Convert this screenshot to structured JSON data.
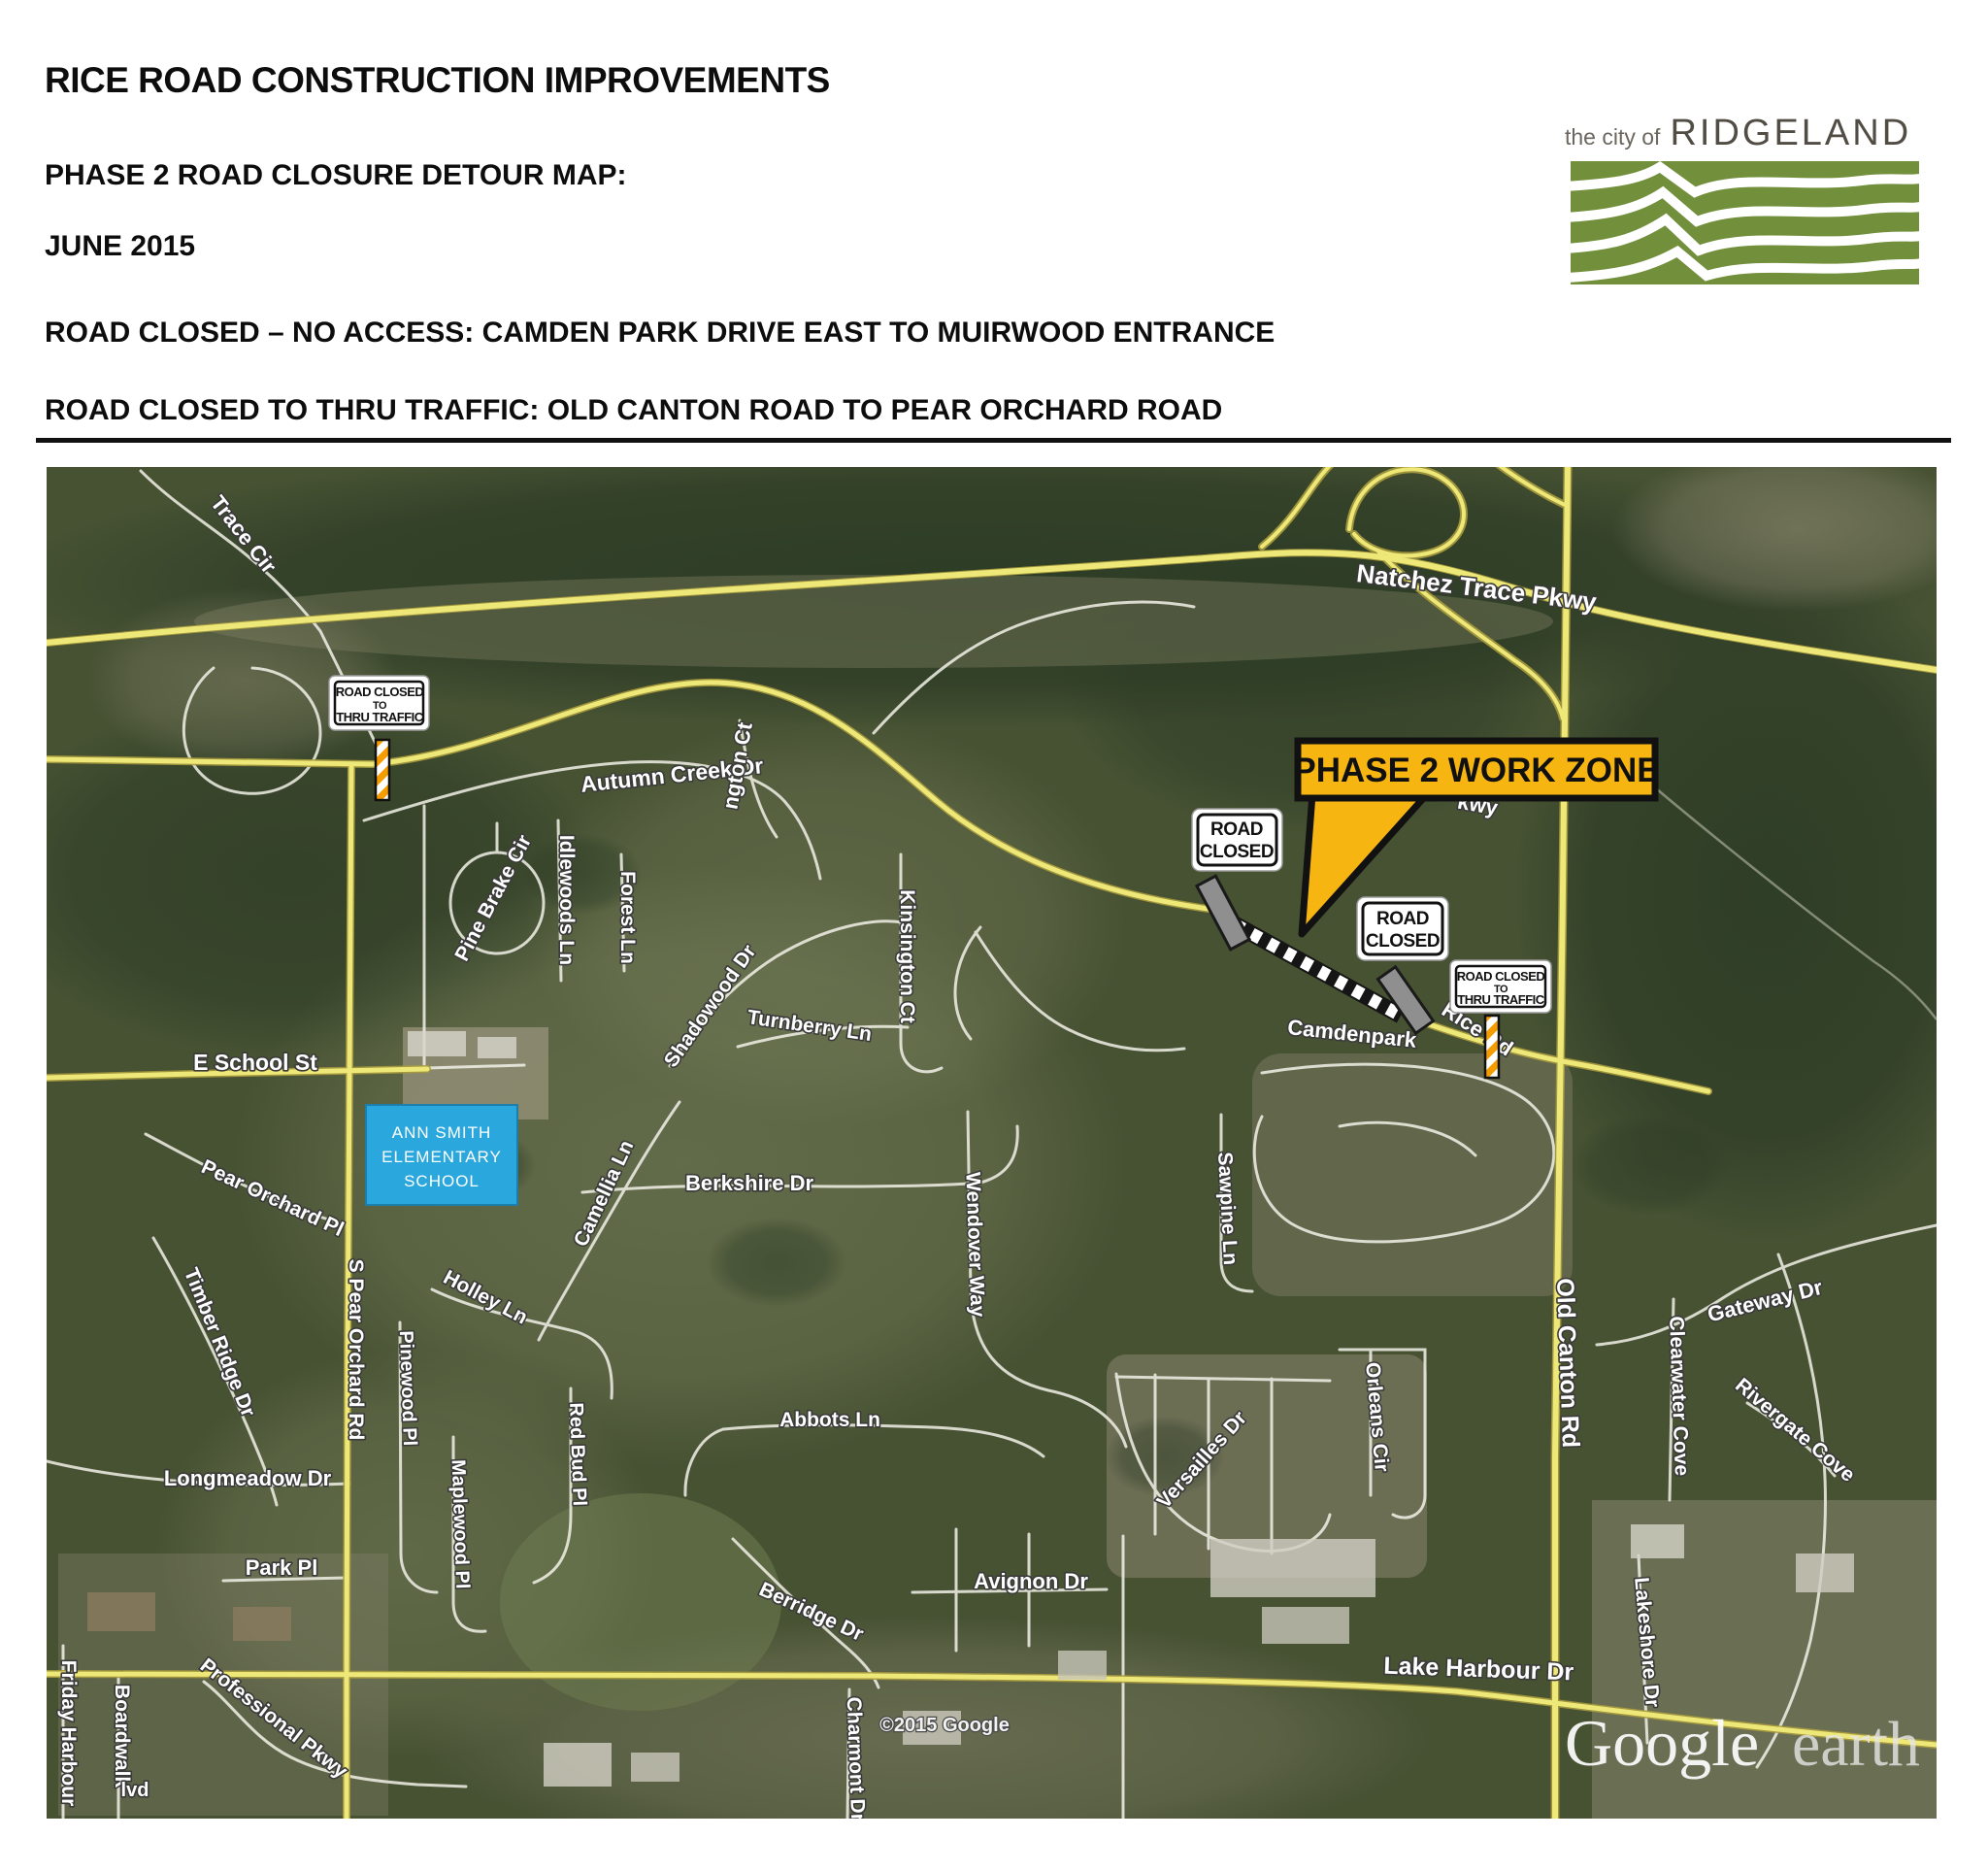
{
  "header": {
    "title": "RICE ROAD CONSTRUCTION IMPROVEMENTS",
    "subtitle": "PHASE 2 ROAD CLOSURE DETOUR MAP:",
    "date": "JUNE 2015",
    "closure_no_access": "ROAD CLOSED – NO ACCESS: CAMDEN PARK DRIVE EAST TO MUIRWOOD ENTRANCE",
    "closure_thru": "ROAD CLOSED TO THRU TRAFFIC:  OLD CANTON ROAD TO PEAR ORCHARD ROAD"
  },
  "logo": {
    "tagline": "the city of",
    "city": "RIDGELAND"
  },
  "colors": {
    "logo_green": "#72903c",
    "callout_bg": "#f7b512",
    "school_bg": "#2aa7dc",
    "school_border": "#1c7fab",
    "road_yellow": "#eee878",
    "sign_bg": "#ffffff"
  },
  "map": {
    "attribution": "©2015 Google",
    "watermark": {
      "brand": "Google",
      "suffix": "earth"
    },
    "callout": {
      "label": "PHASE 2 WORK ZONE"
    },
    "signs": [
      {
        "id": "thru-traffic-west",
        "lines": [
          "ROAD CLOSED",
          "TO",
          "THRU TRAFFIC"
        ]
      },
      {
        "id": "road-closed-west",
        "lines": [
          "ROAD",
          "CLOSED"
        ]
      },
      {
        "id": "road-closed-east",
        "lines": [
          "ROAD",
          "CLOSED"
        ]
      },
      {
        "id": "thru-traffic-east",
        "lines": [
          "ROAD CLOSED",
          "TO",
          "THRU TRAFFIC"
        ]
      }
    ],
    "school": {
      "lines": [
        "ANN SMITH",
        "ELEMENTARY",
        "SCHOOL"
      ]
    },
    "street_labels": [
      {
        "text": "Trace Cir"
      },
      {
        "text": "Natchez Trace Pkwy"
      },
      {
        "text": "Autumn Creek Dr"
      },
      {
        "text": "ngton Ct"
      },
      {
        "text": "Pine Brake Cir"
      },
      {
        "text": "Idlewoods Ln"
      },
      {
        "text": "Forest Ln"
      },
      {
        "text": "Kinsington Ct"
      },
      {
        "text": "Shadowood Dr"
      },
      {
        "text": "Turnberry Ln"
      },
      {
        "text": "E School St"
      },
      {
        "text": "Pear Orchard Pl"
      },
      {
        "text": "Timber Ridge Dr"
      },
      {
        "text": "S Pear Orchard Rd"
      },
      {
        "text": "Berkshire Dr"
      },
      {
        "text": "Camellia Ln"
      },
      {
        "text": "Wendover Way"
      },
      {
        "text": "Abbots Ln"
      },
      {
        "text": "Holley Ln"
      },
      {
        "text": "Pinewood Pl"
      },
      {
        "text": "Maplewood Pl"
      },
      {
        "text": "Red Bud Pl"
      },
      {
        "text": "Longmeadow Dr"
      },
      {
        "text": "Park Pl"
      },
      {
        "text": "Friday Harbour"
      },
      {
        "text": "Boardwalk"
      },
      {
        "text": "lvd"
      },
      {
        "text": "Professional Pkwy"
      },
      {
        "text": "Berridge Dr"
      },
      {
        "text": "Avignon Dr"
      },
      {
        "text": "Charmont Dr"
      },
      {
        "text": "Lake Harbour Dr"
      },
      {
        "text": "Lakeshore Dr"
      },
      {
        "text": "Gateway Dr"
      },
      {
        "text": "Clearwater Cove"
      },
      {
        "text": "Rivergate Cove"
      },
      {
        "text": "Versailles Dr"
      },
      {
        "text": "Orleans Cir"
      },
      {
        "text": "Sawpine Ln"
      },
      {
        "text": "Old Canton Rd"
      },
      {
        "text": "Camdenpark"
      },
      {
        "text": "Rice Rd"
      },
      {
        "text": "kwy"
      }
    ]
  }
}
